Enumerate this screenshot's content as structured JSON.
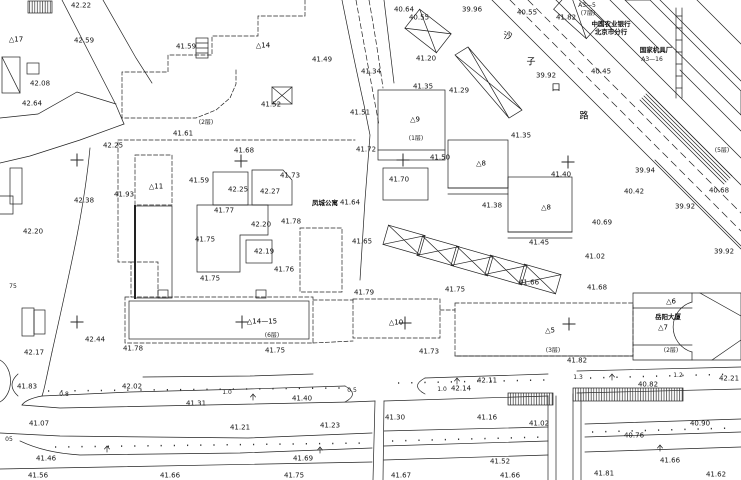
{
  "map": {
    "type": "topographic-survey-plan",
    "colors": {
      "ink": "#1f1f1f",
      "background": "#ffffff"
    },
    "labels": [
      {
        "t": "42.22",
        "x": 81,
        "y": 6
      },
      {
        "t": "42.59",
        "x": 84,
        "y": 41
      },
      {
        "t": "△17",
        "x": 16,
        "y": 40,
        "c": "id"
      },
      {
        "t": "41.59",
        "x": 186,
        "y": 47
      },
      {
        "t": "42.08",
        "x": 40,
        "y": 84
      },
      {
        "t": "42.64",
        "x": 32,
        "y": 104
      },
      {
        "t": "41.61",
        "x": 183,
        "y": 134
      },
      {
        "t": "(2层)",
        "x": 206,
        "y": 123,
        "c": "sm"
      },
      {
        "t": "42.25",
        "x": 113,
        "y": 146
      },
      {
        "t": "△14",
        "x": 263,
        "y": 46,
        "c": "id"
      },
      {
        "t": "41.49",
        "x": 322,
        "y": 60
      },
      {
        "t": "41.52",
        "x": 271,
        "y": 105
      },
      {
        "t": "41.51",
        "x": 360,
        "y": 113
      },
      {
        "t": "40.64",
        "x": 404,
        "y": 10
      },
      {
        "t": "40.55",
        "x": 419,
        "y": 18
      },
      {
        "t": "39.96",
        "x": 472,
        "y": 10
      },
      {
        "t": "41.34",
        "x": 371,
        "y": 72
      },
      {
        "t": "41.20",
        "x": 426,
        "y": 59
      },
      {
        "t": "41.35",
        "x": 423,
        "y": 87
      },
      {
        "t": "41.29",
        "x": 459,
        "y": 91
      },
      {
        "t": "△9",
        "x": 415,
        "y": 120,
        "c": "id"
      },
      {
        "t": "(1层)",
        "x": 416,
        "y": 139,
        "c": "sm"
      },
      {
        "t": "41.35",
        "x": 521,
        "y": 136
      },
      {
        "t": "40.55",
        "x": 527,
        "y": 13
      },
      {
        "t": "41.82",
        "x": 566,
        "y": 18
      },
      {
        "t": "A3—5",
        "x": 587,
        "y": 6,
        "c": "sm"
      },
      {
        "t": "(7层)",
        "x": 588,
        "y": 14,
        "c": "sm"
      },
      {
        "t": "中国农业银行",
        "x": 611,
        "y": 24,
        "c": "cn"
      },
      {
        "t": "北京市分行",
        "x": 611,
        "y": 32,
        "c": "cn"
      },
      {
        "t": "国家机具厂",
        "x": 656,
        "y": 50,
        "c": "cn"
      },
      {
        "t": "A3—16",
        "x": 652,
        "y": 60,
        "c": "sm"
      },
      {
        "t": "沙",
        "x": 508,
        "y": 37,
        "c": "st"
      },
      {
        "t": "子",
        "x": 531,
        "y": 63,
        "c": "st"
      },
      {
        "t": "口",
        "x": 556,
        "y": 89,
        "c": "st"
      },
      {
        "t": "路",
        "x": 584,
        "y": 117,
        "c": "st"
      },
      {
        "t": "40.45",
        "x": 601,
        "y": 72
      },
      {
        "t": "39.92",
        "x": 546,
        "y": 76
      },
      {
        "t": "39.94",
        "x": 645,
        "y": 171
      },
      {
        "t": "40.42",
        "x": 634,
        "y": 192
      },
      {
        "t": "39.92",
        "x": 685,
        "y": 207
      },
      {
        "t": "40.68",
        "x": 719,
        "y": 191
      },
      {
        "t": "40.69",
        "x": 602,
        "y": 223
      },
      {
        "t": "39.92",
        "x": 724,
        "y": 252
      },
      {
        "t": "(5层)",
        "x": 722,
        "y": 151,
        "c": "sm"
      },
      {
        "t": "41.72",
        "x": 366,
        "y": 150
      },
      {
        "t": "41.50",
        "x": 440,
        "y": 158
      },
      {
        "t": "41.70",
        "x": 399,
        "y": 180
      },
      {
        "t": "△8",
        "x": 481,
        "y": 164,
        "c": "id"
      },
      {
        "t": "41.38",
        "x": 492,
        "y": 206
      },
      {
        "t": "△8",
        "x": 546,
        "y": 208,
        "c": "id"
      },
      {
        "t": "41.40",
        "x": 561,
        "y": 175
      },
      {
        "t": "41.45",
        "x": 539,
        "y": 243
      },
      {
        "t": "41.02",
        "x": 595,
        "y": 257
      },
      {
        "t": "41.68",
        "x": 597,
        "y": 288
      },
      {
        "t": "41.68",
        "x": 244,
        "y": 151
      },
      {
        "t": "41.59",
        "x": 199,
        "y": 181
      },
      {
        "t": "42.25",
        "x": 238,
        "y": 190
      },
      {
        "t": "42.27",
        "x": 270,
        "y": 192
      },
      {
        "t": "41.73",
        "x": 290,
        "y": 176
      },
      {
        "t": "41.77",
        "x": 224,
        "y": 211
      },
      {
        "t": "42.20",
        "x": 261,
        "y": 225
      },
      {
        "t": "41.78",
        "x": 291,
        "y": 222
      },
      {
        "t": "41.75",
        "x": 205,
        "y": 240
      },
      {
        "t": "42.19",
        "x": 264,
        "y": 252
      },
      {
        "t": "41.76",
        "x": 284,
        "y": 270
      },
      {
        "t": "41.75",
        "x": 210,
        "y": 279
      },
      {
        "t": "41.93",
        "x": 124,
        "y": 195
      },
      {
        "t": "△11",
        "x": 156,
        "y": 187,
        "c": "id"
      },
      {
        "t": "42.38",
        "x": 84,
        "y": 201
      },
      {
        "t": "42.20",
        "x": 33,
        "y": 232
      },
      {
        "t": "75",
        "x": 13,
        "y": 287,
        "c": "sm"
      },
      {
        "t": "凤城公寓",
        "x": 325,
        "y": 203,
        "c": "cn"
      },
      {
        "t": "41.64",
        "x": 350,
        "y": 203
      },
      {
        "t": "41.65",
        "x": 362,
        "y": 242
      },
      {
        "t": "41.79",
        "x": 364,
        "y": 293
      },
      {
        "t": "41.75",
        "x": 455,
        "y": 290
      },
      {
        "t": "41.66",
        "x": 529,
        "y": 283
      },
      {
        "t": "42.44",
        "x": 95,
        "y": 340
      },
      {
        "t": "42.17",
        "x": 34,
        "y": 353
      },
      {
        "t": "41.78",
        "x": 133,
        "y": 349
      },
      {
        "t": "△14—15",
        "x": 262,
        "y": 322,
        "c": "id"
      },
      {
        "t": "(6层)",
        "x": 272,
        "y": 336,
        "c": "sm"
      },
      {
        "t": "41.75",
        "x": 275,
        "y": 351
      },
      {
        "t": "△10",
        "x": 396,
        "y": 323,
        "c": "id"
      },
      {
        "t": "41.73",
        "x": 429,
        "y": 352
      },
      {
        "t": "△5",
        "x": 550,
        "y": 331,
        "c": "id"
      },
      {
        "t": "(3层)",
        "x": 553,
        "y": 351,
        "c": "sm"
      },
      {
        "t": "41.82",
        "x": 577,
        "y": 361
      },
      {
        "t": "岳阳大厦",
        "x": 668,
        "y": 317,
        "c": "cn"
      },
      {
        "t": "△7",
        "x": 663,
        "y": 328,
        "c": "id"
      },
      {
        "t": "(2层)",
        "x": 671,
        "y": 351,
        "c": "sm"
      },
      {
        "t": "△6",
        "x": 671,
        "y": 302,
        "c": "id"
      },
      {
        "t": "42.21",
        "x": 729,
        "y": 379
      },
      {
        "t": "1.3",
        "x": 578,
        "y": 378,
        "c": "sm"
      },
      {
        "t": "1.2",
        "x": 678,
        "y": 376,
        "c": "sm"
      },
      {
        "t": "40.82",
        "x": 648,
        "y": 385
      },
      {
        "t": "40.90",
        "x": 700,
        "y": 424
      },
      {
        "t": "40.76",
        "x": 634,
        "y": 436
      },
      {
        "t": "41.02",
        "x": 539,
        "y": 424
      },
      {
        "t": "41.66",
        "x": 670,
        "y": 461
      },
      {
        "t": "41.62",
        "x": 716,
        "y": 475
      },
      {
        "t": "41.81",
        "x": 604,
        "y": 474
      },
      {
        "t": "41.66",
        "x": 510,
        "y": 476
      },
      {
        "t": "41.67",
        "x": 401,
        "y": 476
      },
      {
        "t": "41.52",
        "x": 500,
        "y": 462
      },
      {
        "t": "41.83",
        "x": 27,
        "y": 387
      },
      {
        "t": "42.02",
        "x": 132,
        "y": 387
      },
      {
        "t": "0.8",
        "x": 64,
        "y": 395,
        "c": "sm"
      },
      {
        "t": "1.0",
        "x": 227,
        "y": 393,
        "c": "sm"
      },
      {
        "t": "41.31",
        "x": 196,
        "y": 404
      },
      {
        "t": "41.07",
        "x": 39,
        "y": 424
      },
      {
        "t": "41.21",
        "x": 240,
        "y": 428
      },
      {
        "t": "41.23",
        "x": 330,
        "y": 426
      },
      {
        "t": "41.46",
        "x": 46,
        "y": 459
      },
      {
        "t": "05",
        "x": 9,
        "y": 440,
        "c": "sm"
      },
      {
        "t": "41.56",
        "x": 38,
        "y": 476
      },
      {
        "t": "41.66",
        "x": 170,
        "y": 476
      },
      {
        "t": "41.75",
        "x": 294,
        "y": 476
      },
      {
        "t": "41.69",
        "x": 303,
        "y": 459
      },
      {
        "t": "41.40",
        "x": 302,
        "y": 399
      },
      {
        "t": "0.5",
        "x": 352,
        "y": 391,
        "c": "sm"
      },
      {
        "t": "41.30",
        "x": 395,
        "y": 418
      },
      {
        "t": "1.0",
        "x": 442,
        "y": 390,
        "c": "sm"
      },
      {
        "t": "42.14",
        "x": 461,
        "y": 389
      },
      {
        "t": "42.11",
        "x": 487,
        "y": 381
      },
      {
        "t": "41.16",
        "x": 487,
        "y": 418
      }
    ],
    "crosses": [
      [
        77,
        160
      ],
      [
        241,
        161
      ],
      [
        403,
        160
      ],
      [
        568,
        162
      ],
      [
        77,
        322
      ],
      [
        242,
        322
      ],
      [
        405,
        323
      ],
      [
        569,
        324
      ]
    ]
  }
}
